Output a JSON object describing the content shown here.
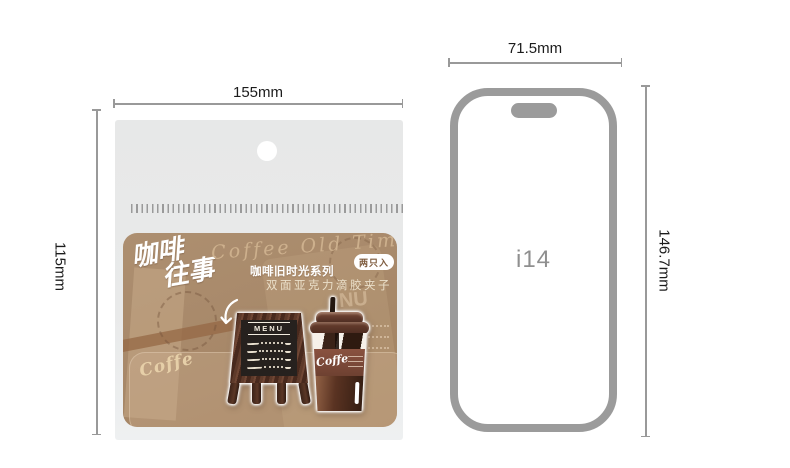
{
  "dimensions": {
    "package_width": "155mm",
    "package_height": "115mm",
    "phone_width": "71.5mm",
    "phone_height": "146.7mm"
  },
  "package": {
    "card": {
      "title_cn_line1": "咖啡",
      "title_cn_line2": "往事",
      "title_en_script": "Coffee Old Time",
      "badge_label": "两只入",
      "series_label": "咖啡旧时光系列",
      "product_label": "双面亚克力滴胶夹子",
      "deco_coffe_text": "Coffe",
      "deco_menu_fragment": "NU"
    },
    "stickers": {
      "menu_board": {
        "header": "MENU"
      },
      "coffee_cup": {
        "label": "Coffe"
      }
    }
  },
  "phone": {
    "model_label": "i14"
  },
  "colors": {
    "card_brown": "#a8896a",
    "bag_gray": "#e9eaea",
    "dimension_line": "#999999",
    "dimension_text": "#1c1c1c",
    "phone_outline": "#9b9b9b",
    "phone_label": "#8f8f8f"
  }
}
